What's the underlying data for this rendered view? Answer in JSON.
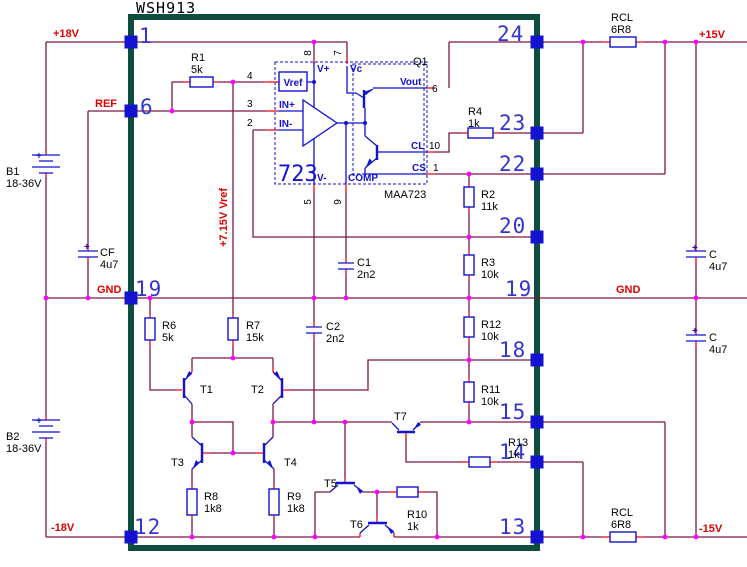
{
  "title": "WSH913",
  "nets": {
    "p18": "+18V",
    "ref": "REF",
    "gnd_left": "GND",
    "n18": "-18V",
    "p15": "+15V",
    "gnd_right": "GND",
    "n15": "-15V",
    "vref_rail": "+7.15V Vref"
  },
  "package_pins": {
    "p1": "1",
    "p6": "6",
    "p19_left": "19",
    "p12": "12",
    "p24": "24",
    "p23": "23",
    "p22": "22",
    "p20": "20",
    "p19_right": "19",
    "p18": "18",
    "p15": "15",
    "p14": "14",
    "p13": "13"
  },
  "ic": {
    "name": "723",
    "part": "MAA723",
    "group": "Q1",
    "labels": {
      "vref": "Vref",
      "in_plus": "IN+",
      "in_minus": "IN-",
      "v_plus": "V+",
      "vc": "Vc",
      "vout": "Vout",
      "cl": "CL",
      "cs": "CS",
      "v_minus": "V-",
      "comp": "COMP"
    },
    "pins": {
      "n4": "4",
      "n3": "3",
      "n2": "2",
      "n8": "8",
      "n7": "7",
      "n6": "6",
      "n10": "10",
      "n1": "1",
      "n5": "5",
      "n9": "9"
    }
  },
  "components": {
    "b1": {
      "ref": "B1",
      "value": "18-36V"
    },
    "b2": {
      "ref": "B2",
      "value": "18-36V"
    },
    "cf": {
      "ref": "CF",
      "value": "4u7"
    },
    "c_top": {
      "ref": "C",
      "value": "4u7"
    },
    "c_bottom": {
      "ref": "C",
      "value": "4u7"
    },
    "rcl_top": {
      "ref": "RCL",
      "value": "6R8"
    },
    "rcl_bottom": {
      "ref": "RCL",
      "value": "6R8"
    },
    "r1": {
      "ref": "R1",
      "value": "5k"
    },
    "r2": {
      "ref": "R2",
      "value": "11k"
    },
    "r3": {
      "ref": "R3",
      "value": "10k"
    },
    "r4": {
      "ref": "R4",
      "value": "1k"
    },
    "r6": {
      "ref": "R6",
      "value": "5k"
    },
    "r7": {
      "ref": "R7",
      "value": "15k"
    },
    "r8": {
      "ref": "R8",
      "value": "1k8"
    },
    "r9": {
      "ref": "R9",
      "value": "1k8"
    },
    "r10": {
      "ref": "R10",
      "value": "1k"
    },
    "r11": {
      "ref": "R11",
      "value": "10k"
    },
    "r12": {
      "ref": "R12",
      "value": "10k"
    },
    "r13": {
      "ref": "R13",
      "value": "1k"
    },
    "c1": {
      "ref": "C1",
      "value": "2n2"
    },
    "c2": {
      "ref": "C2",
      "value": "2n2"
    },
    "t1": {
      "ref": "T1"
    },
    "t2": {
      "ref": "T2"
    },
    "t3": {
      "ref": "T3"
    },
    "t4": {
      "ref": "T4"
    },
    "t5": {
      "ref": "T5"
    },
    "t6": {
      "ref": "T6"
    },
    "t7": {
      "ref": "T7"
    }
  },
  "symbols": {
    "plus": "+"
  },
  "colors": {
    "wire": "#7a1845",
    "pin_wire": "#fb0207",
    "symbol": "#1212d0",
    "junction": "#ff00ff",
    "border": "#0d4d40",
    "net_label": "#e00000"
  }
}
